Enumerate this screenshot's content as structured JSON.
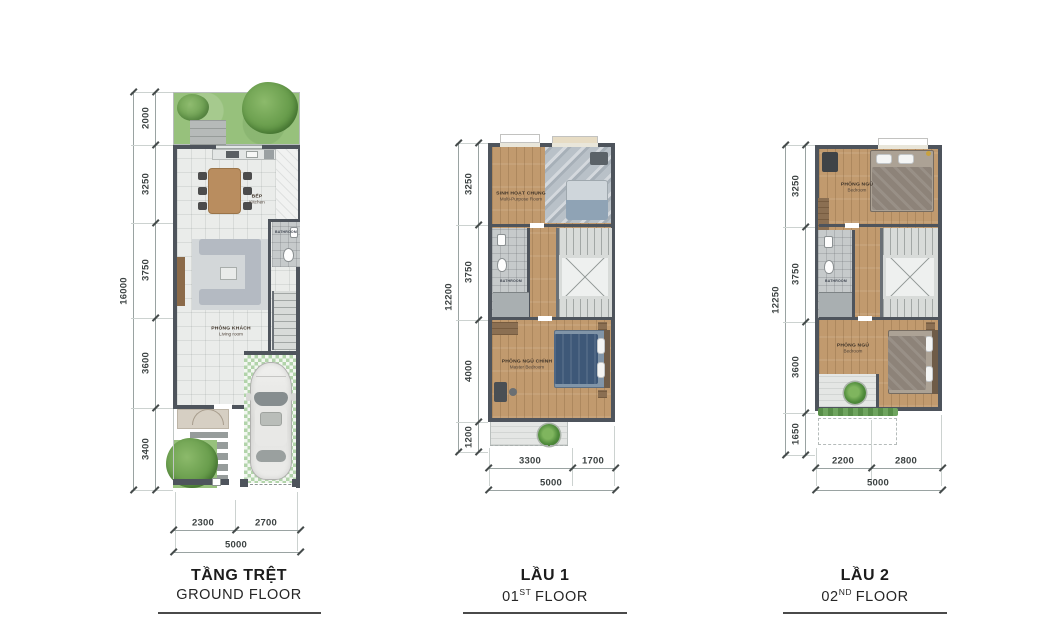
{
  "plans": {
    "ground": {
      "title_vi": "TẦNG TRỆT",
      "title_en": "GROUND FLOOR",
      "overall_height": "16000",
      "overall_width": "5000",
      "left_dims": [
        "2000",
        "3250",
        "3750",
        "3600",
        "3400"
      ],
      "bottom_dims": [
        "2300",
        "2700"
      ],
      "rooms": {
        "kitchen_vi": "BẾP",
        "kitchen_en": "Kitchen",
        "living_vi": "PHÒNG KHÁCH",
        "living_en": "Living room",
        "bathroom_en": "BATHROOM"
      }
    },
    "floor1": {
      "title_vi": "LẦU 1",
      "title_num": "01",
      "title_ord": "ST",
      "title_word": "FLOOR",
      "overall_height": "12200",
      "overall_width": "5000",
      "left_dims": [
        "3250",
        "3750",
        "4000",
        "1200"
      ],
      "bottom_dims": [
        "3300",
        "1700"
      ],
      "rooms": {
        "multi_vi": "SINH HOẠT CHUNG",
        "multi_en": "Multi-Purpose Room",
        "bathroom_en": "BATHROOM",
        "master_vi": "PHÒNG NGỦ CHÍNH",
        "master_en": "Master Bedroom"
      }
    },
    "floor2": {
      "title_vi": "LẦU 2",
      "title_num": "02",
      "title_ord": "ND",
      "title_word": "FLOOR",
      "overall_height": "12250",
      "overall_width": "5000",
      "left_dims": [
        "3250",
        "3750",
        "3600",
        "1650"
      ],
      "bottom_dims": [
        "2200",
        "2800"
      ],
      "rooms": {
        "bedroom1_vi": "PHÒNG NGỦ",
        "bedroom1_en": "Bedroom",
        "bathroom_en": "BATHROOM",
        "bedroom2_vi": "PHÒNG NGỦ",
        "bedroom2_en": "Bedroom"
      }
    }
  }
}
